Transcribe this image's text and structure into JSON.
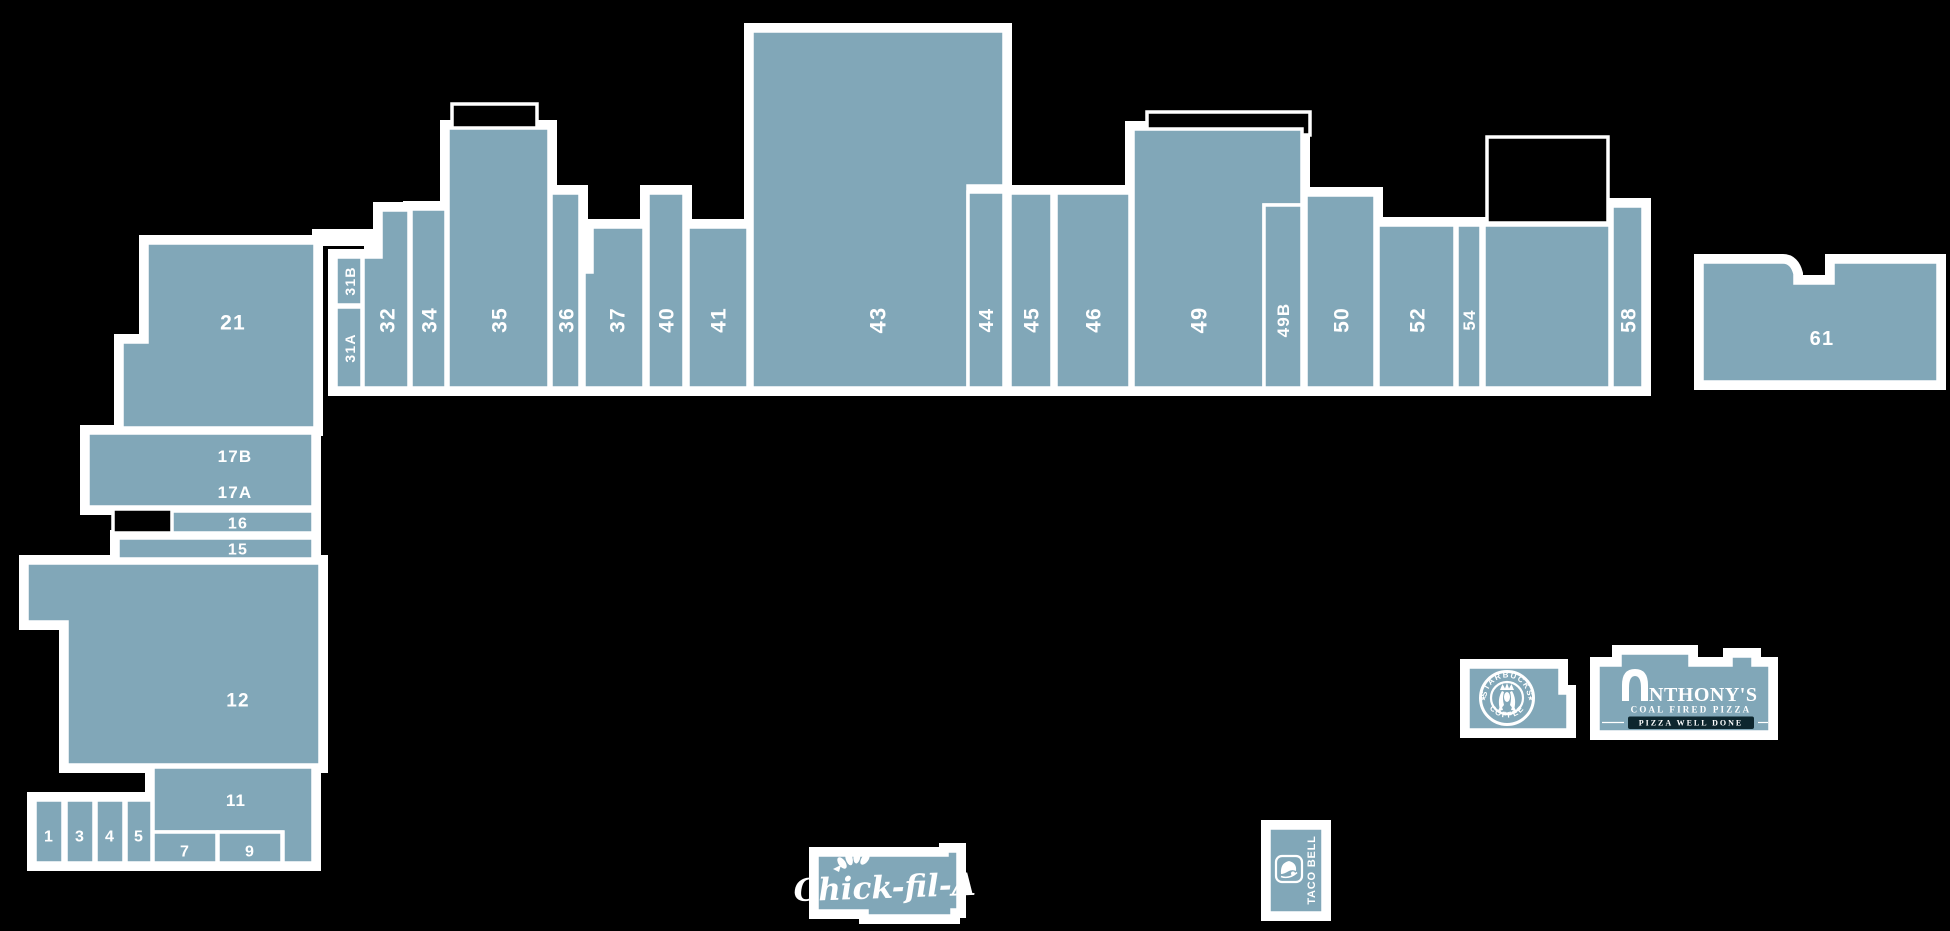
{
  "colors": {
    "background": "#000000",
    "building": "#81a7b8",
    "outline": "#ffffff",
    "banner": "#0d262e"
  },
  "units": [
    {
      "id": "21",
      "d": "M147,243 L315,243 L315,428 L122,428 L122,342 L147,342 Z",
      "labels": [
        {
          "t": "21",
          "x": 233,
          "y": 322,
          "r": 0,
          "s": 21
        }
      ]
    },
    {
      "id": "17",
      "d": "M88,433 L313,433 L313,507 L88,507 Z",
      "labels": [
        {
          "t": "17B",
          "x": 235,
          "y": 456,
          "r": 0,
          "s": 17
        },
        {
          "t": "17A",
          "x": 235,
          "y": 492,
          "r": 0,
          "s": 17
        }
      ]
    },
    {
      "id": "16",
      "d": "M172,511 L313,511 L313,533 L172,533 Z",
      "labels": [
        {
          "t": "16",
          "x": 238,
          "y": 523,
          "r": 0,
          "s": 16
        }
      ]
    },
    {
      "id": "15",
      "d": "M118,538 L313,538 L313,559 L118,559 Z",
      "labels": [
        {
          "t": "15",
          "x": 238,
          "y": 549,
          "r": 0,
          "s": 16
        }
      ]
    },
    {
      "id": "12",
      "d": "M27,563 L320,563 L320,765 L67,765 L67,622 L27,622 Z",
      "labels": [
        {
          "t": "12",
          "x": 238,
          "y": 700,
          "r": 0,
          "s": 19
        }
      ]
    },
    {
      "id": "11",
      "d": "M153,767 L313,767 L313,863 L283,863 L283,832 L153,832 Z",
      "labels": [
        {
          "t": "11",
          "x": 236,
          "y": 800,
          "r": 0,
          "s": 17
        }
      ]
    },
    {
      "id": "7",
      "d": "M153,832 L217,832 L217,863 L153,863 Z",
      "labels": [
        {
          "t": "7",
          "x": 185,
          "y": 851,
          "r": 0,
          "s": 16
        }
      ]
    },
    {
      "id": "9",
      "d": "M218,832 L282,832 L282,863 L218,863 Z",
      "labels": [
        {
          "t": "9",
          "x": 250,
          "y": 851,
          "r": 0,
          "s": 16
        }
      ]
    },
    {
      "id": "1",
      "d": "M35,800 L63,800 L63,863 L35,863 Z",
      "labels": [
        {
          "t": "1",
          "x": 49,
          "y": 836,
          "r": 0,
          "s": 16
        }
      ]
    },
    {
      "id": "3",
      "d": "M66,800 L94,800 L94,863 L66,863 Z",
      "labels": [
        {
          "t": "3",
          "x": 80,
          "y": 836,
          "r": 0,
          "s": 16
        }
      ]
    },
    {
      "id": "4",
      "d": "M96,800 L124,800 L124,863 L96,863 Z",
      "labels": [
        {
          "t": "4",
          "x": 110,
          "y": 836,
          "r": 0,
          "s": 16
        }
      ]
    },
    {
      "id": "5",
      "d": "M126,800 L152,800 L152,863 L126,863 Z",
      "labels": [
        {
          "t": "5",
          "x": 139,
          "y": 836,
          "r": 0,
          "s": 16
        }
      ]
    },
    {
      "id": "31A",
      "d": "M336,307 L362,307 L362,388 L336,388 Z",
      "labels": [
        {
          "t": "31A",
          "x": 350,
          "y": 348,
          "r": -90,
          "s": 14
        }
      ]
    },
    {
      "id": "31B",
      "d": "M336,257 L362,257 L362,305 L336,305 Z",
      "labels": [
        {
          "t": "31B",
          "x": 350,
          "y": 281,
          "r": -90,
          "s": 14
        }
      ]
    },
    {
      "id": "32",
      "d": "M363,257 L381,257 L381,210 L409,210 L409,388 L363,388 Z",
      "labels": [
        {
          "t": "32",
          "x": 387,
          "y": 320,
          "r": -90,
          "s": 21
        }
      ]
    },
    {
      "id": "34",
      "d": "M411,209 L446,209 L446,388 L411,388 Z",
      "labels": [
        {
          "t": "34",
          "x": 429,
          "y": 320,
          "r": -90,
          "s": 21
        }
      ]
    },
    {
      "id": "35",
      "d": "M448,128 L549,128 L549,388 L448,388 Z",
      "labels": [
        {
          "t": "35",
          "x": 499,
          "y": 320,
          "r": -90,
          "s": 21
        }
      ]
    },
    {
      "id": "36",
      "d": "M551,193 L580,193 L580,388 L551,388 Z",
      "labels": [
        {
          "t": "36",
          "x": 566,
          "y": 320,
          "r": -90,
          "s": 21
        }
      ]
    },
    {
      "id": "37",
      "d": "M592,227 L644,227 L644,388 L584,388 L584,272 L592,272 Z",
      "labels": [
        {
          "t": "37",
          "x": 617,
          "y": 320,
          "r": -90,
          "s": 21
        }
      ]
    },
    {
      "id": "40",
      "d": "M648,193 L684,193 L684,388 L648,388 Z",
      "labels": [
        {
          "t": "40",
          "x": 666,
          "y": 320,
          "r": -90,
          "s": 21
        }
      ]
    },
    {
      "id": "41",
      "d": "M688,227 L748,227 L748,388 L688,388 Z",
      "labels": [
        {
          "t": "41",
          "x": 718,
          "y": 320,
          "r": -90,
          "s": 21
        }
      ]
    },
    {
      "id": "43",
      "d": "M752,31 L1004,31 L1004,186 L968,186 L968,388 L752,388 Z",
      "labels": [
        {
          "t": "43",
          "x": 878,
          "y": 320,
          "r": -90,
          "s": 22
        }
      ]
    },
    {
      "id": "44",
      "d": "M968,192 L1004,192 L1004,388 L968,388 Z",
      "labels": [
        {
          "t": "44",
          "x": 986,
          "y": 320,
          "r": -90,
          "s": 20
        }
      ]
    },
    {
      "id": "45",
      "d": "M1010,193 L1052,193 L1052,388 L1010,388 Z",
      "labels": [
        {
          "t": "45",
          "x": 1031,
          "y": 320,
          "r": -90,
          "s": 21
        }
      ]
    },
    {
      "id": "46",
      "d": "M1056,193 L1130,193 L1130,388 L1056,388 Z",
      "labels": [
        {
          "t": "46",
          "x": 1093,
          "y": 320,
          "r": -90,
          "s": 21
        }
      ]
    },
    {
      "id": "49",
      "d": "M1133,129 L1302,129 L1302,205 L1264,205 L1264,388 L1133,388 Z",
      "labels": [
        {
          "t": "49",
          "x": 1199,
          "y": 320,
          "r": -90,
          "s": 22
        }
      ]
    },
    {
      "id": "49B",
      "d": "M1264,205 L1302,205 L1302,388 L1264,388 Z",
      "labels": [
        {
          "t": "49B",
          "x": 1283,
          "y": 320,
          "r": -90,
          "s": 17
        }
      ]
    },
    {
      "id": "50",
      "d": "M1306,195 L1375,195 L1375,388 L1306,388 Z",
      "labels": [
        {
          "t": "50",
          "x": 1341,
          "y": 320,
          "r": -90,
          "s": 21
        }
      ]
    },
    {
      "id": "52",
      "d": "M1378,225 L1455,225 L1455,388 L1378,388 Z",
      "labels": [
        {
          "t": "52",
          "x": 1417,
          "y": 320,
          "r": -90,
          "s": 21
        }
      ]
    },
    {
      "id": "54",
      "d": "M1457,225 L1481,225 L1481,388 L1457,388 Z",
      "labels": [
        {
          "t": "54",
          "x": 1469,
          "y": 320,
          "r": -90,
          "s": 17
        }
      ]
    },
    {
      "id": "56",
      "d": "M1484,225 L1610,225 L1610,388 L1484,388 Z",
      "labels": []
    },
    {
      "id": "58",
      "d": "M1612,206 L1643,206 L1643,388 L1612,388 Z",
      "labels": [
        {
          "t": "58",
          "x": 1628,
          "y": 320,
          "r": -90,
          "s": 21
        }
      ]
    },
    {
      "id": "61",
      "d": "M1702,262 L1783,262 Q1792,262 1795,274 L1795,283 L1833,283 L1833,262 L1938,262 L1938,382 L1702,382 Z",
      "labels": [
        {
          "t": "61",
          "x": 1822,
          "y": 338,
          "r": 0,
          "s": 20
        }
      ]
    }
  ],
  "tenant_buildings": [
    {
      "id": "starbucks-building",
      "d": "M1468,667 L1560,667 L1560,693 L1568,693 L1568,730 L1468,730 Z"
    },
    {
      "id": "anthonys-building",
      "d": "M1598,665 L1620,665 L1620,653 L1690,653 L1690,665 L1731,665 L1731,656 L1753,656 L1753,665 L1770,665 L1770,732 L1598,732 Z"
    },
    {
      "id": "chickfila-building",
      "d": "M817,855 L947,855 L947,851 L958,851 L958,910 L952,910 L952,916 L867,916 L867,911 L817,911 Z"
    },
    {
      "id": "tacobell-building",
      "d": "M1269,828 L1323,828 L1323,913 L1269,913 Z"
    }
  ],
  "courtyards": [
    {
      "d": "M1487,137 L1608,137 L1608,223 L1487,223 Z"
    },
    {
      "d": "M1147,112 L1310,112 L1310,135 L1147,135 Z"
    },
    {
      "d": "M452,104 L537,104 L537,130 L452,130 Z"
    },
    {
      "d": "M113,509 L174,509 L174,533 L113,533 Z"
    }
  ],
  "halo_extras": [
    {
      "d": "M312,229 L378,229 L378,262 L364,262 L364,246 L312,246 Z"
    }
  ],
  "tenants": {
    "starbucks": {
      "ring_top": "STARBUCKS",
      "ring_bottom": "COFFEE",
      "star": "★"
    },
    "anthonys": {
      "name": "ANTHONY'S",
      "name_after_icon": "NTHONY'S",
      "tagline": "COAL FIRED PIZZA",
      "banner": "PIZZA WELL DONE"
    },
    "chickfila": {
      "name": "Chick-fil-A"
    },
    "tacobell": {
      "name": "TACO BELL"
    }
  }
}
